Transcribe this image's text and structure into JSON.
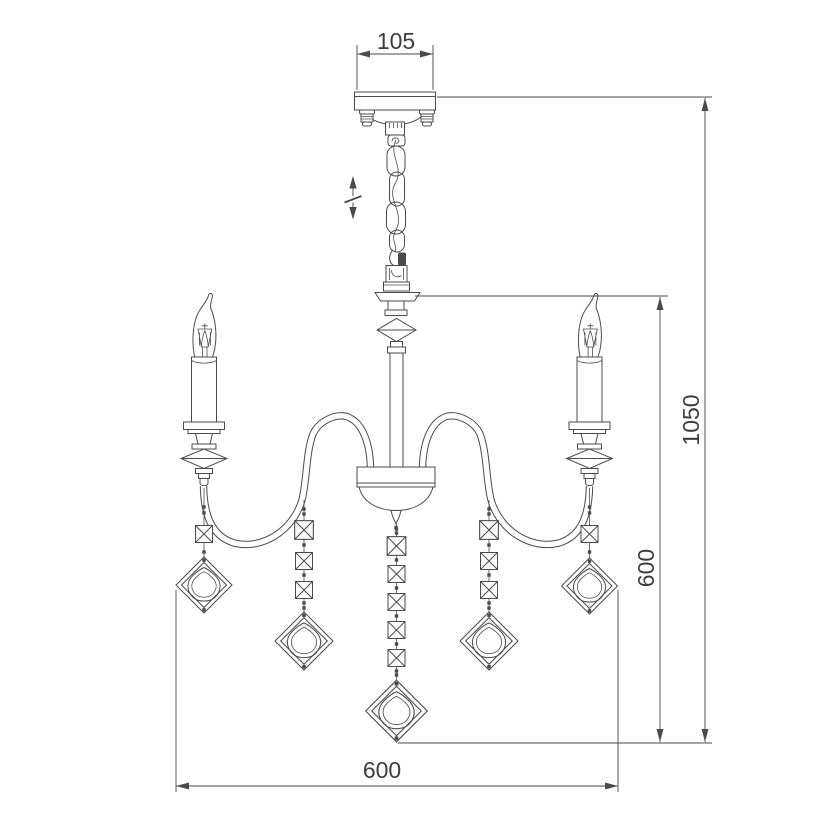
{
  "page": {
    "background": "#ffffff"
  },
  "diagram": {
    "type": "technical line drawing",
    "subject": "crystal chandelier front elevation with dimensions",
    "dimensions": {
      "canopy_width": "105",
      "overall_height": "1050",
      "drop_height": "600",
      "body_width": "600"
    },
    "features": {
      "height_adjust_symbol": "double-headed vertical arrow with break mark beside suspension chain",
      "visible_candle_arms": 2,
      "crystal_bead_strands": 5,
      "beads_per_strand": [
        1,
        3,
        5,
        3,
        1
      ],
      "pendant_drops": 5
    },
    "colors": {
      "line": "#4b4b4b",
      "dimension_text": "#3d3d3d",
      "background": "#ffffff"
    }
  }
}
